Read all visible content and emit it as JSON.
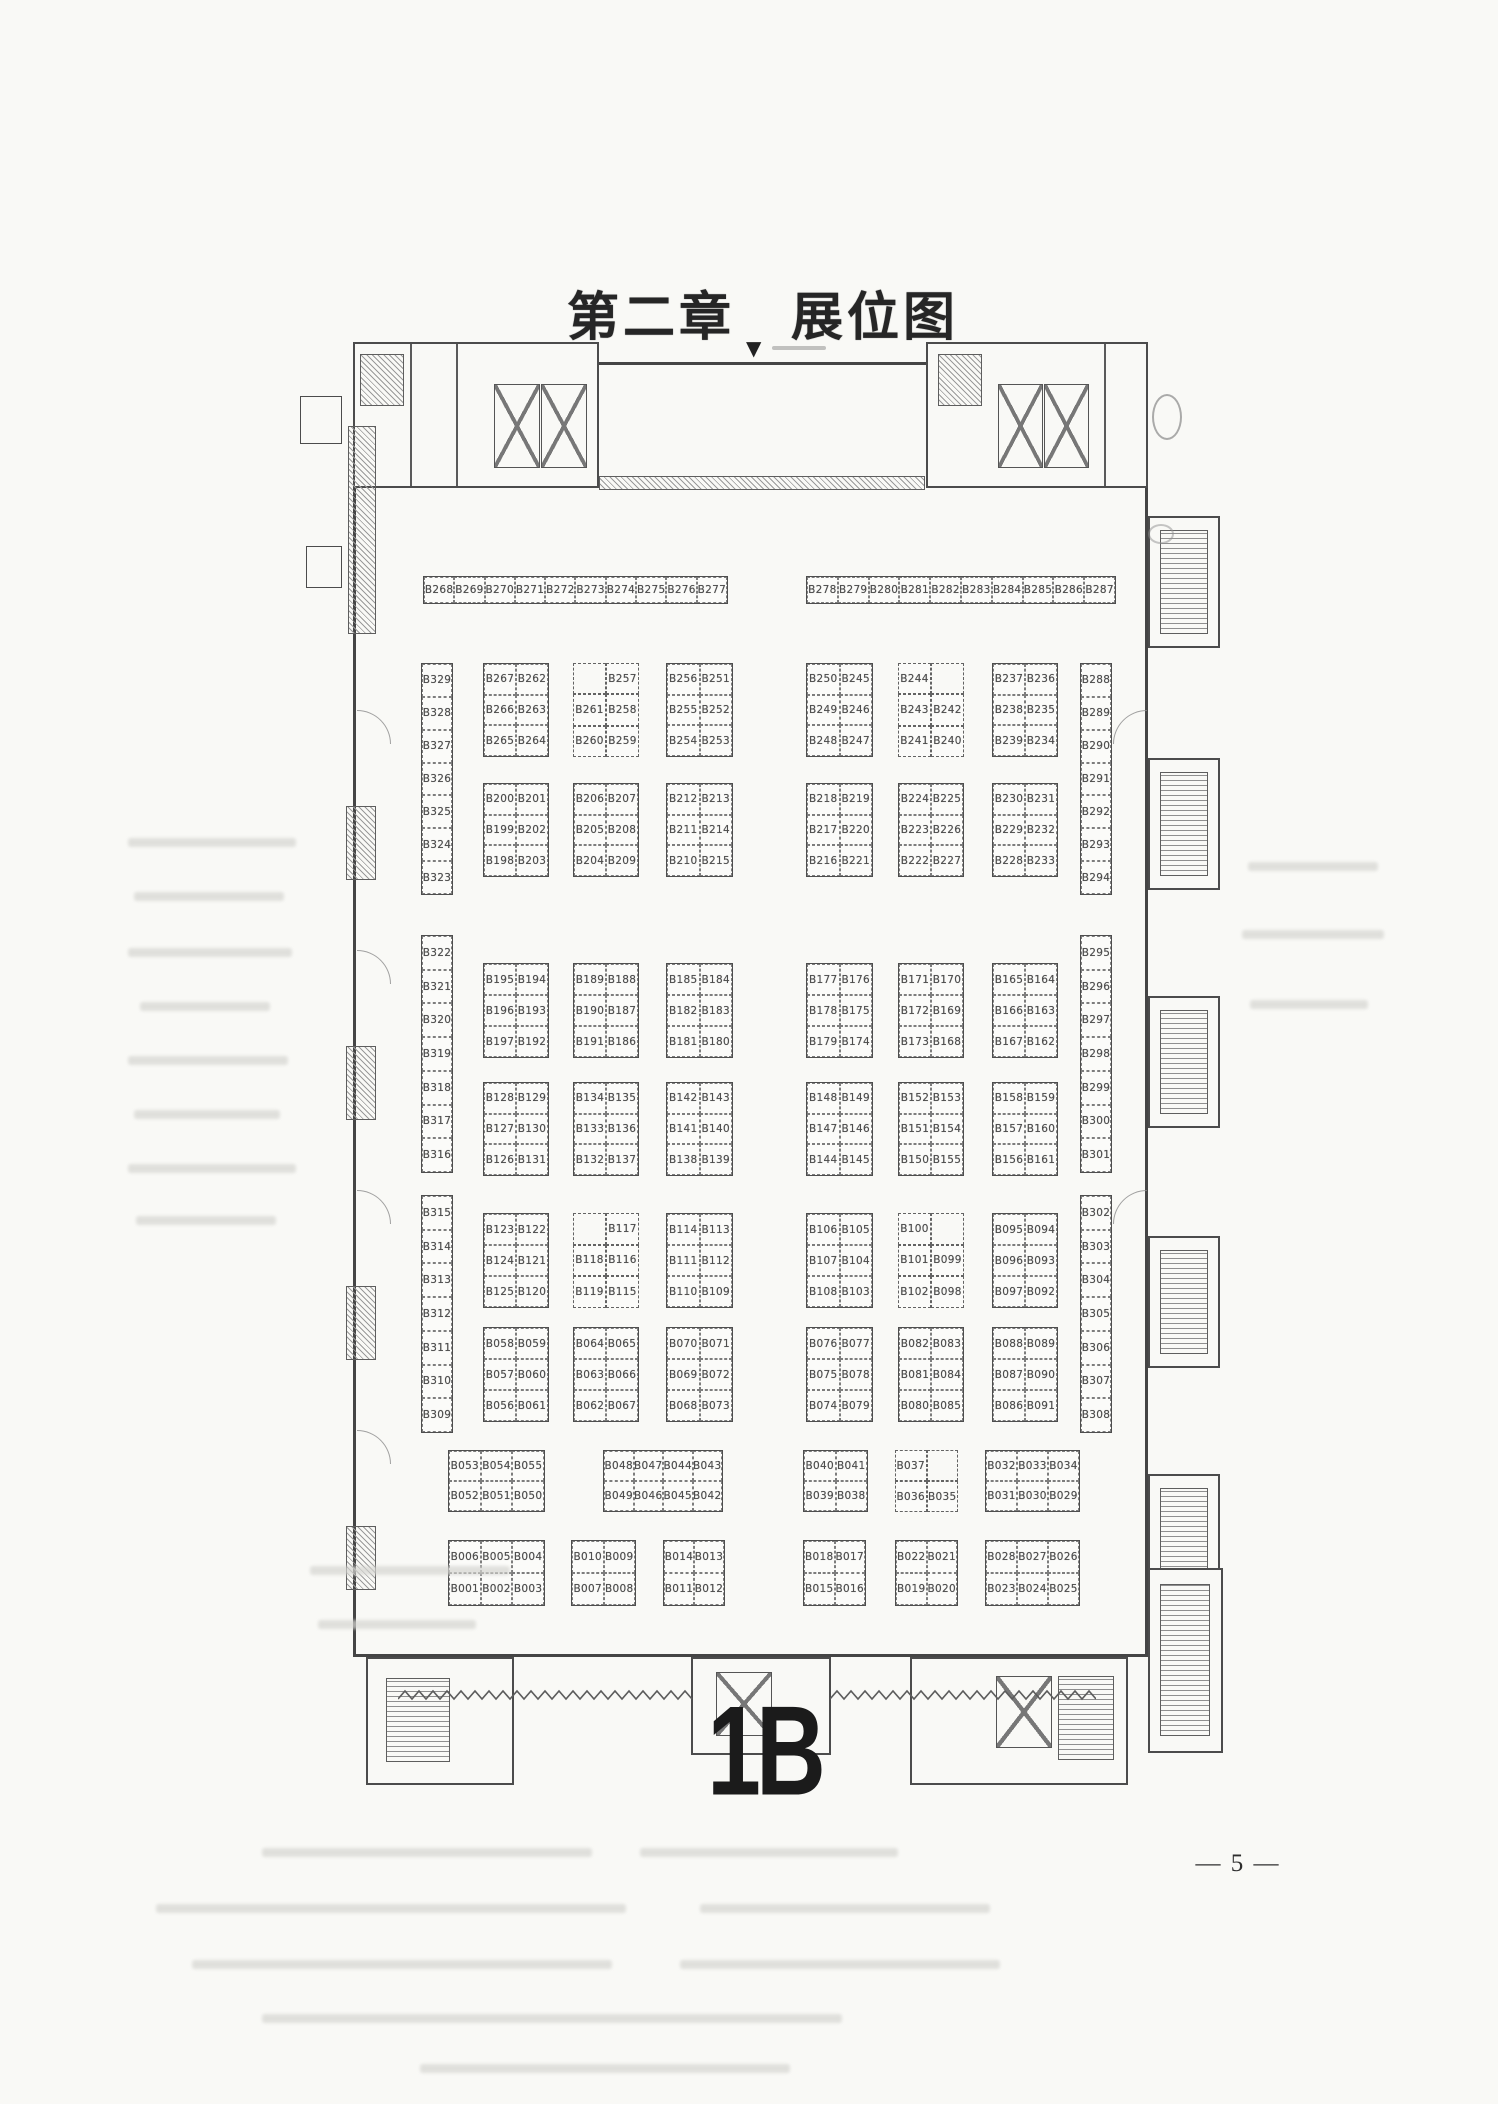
{
  "page": {
    "title": "第二章　展位图",
    "hall_label": "1B",
    "page_number": "— 5 —",
    "top_marker": "▼"
  },
  "plan": {
    "highlighted_booth": "B032",
    "highlight_color": "#d4466a",
    "groups": [
      {
        "name": "strip-left",
        "x": 125,
        "y": 238,
        "w": 305,
        "h": 28,
        "cols": 10,
        "cells": [
          "B268",
          "B269",
          "B270",
          "B271",
          "B272",
          "B273",
          "B274",
          "B275",
          "B276",
          "B277"
        ]
      },
      {
        "name": "strip-right",
        "x": 508,
        "y": 238,
        "w": 310,
        "h": 28,
        "cols": 10,
        "cells": [
          "B278",
          "B279",
          "B280",
          "B281",
          "B282",
          "B283",
          "B284",
          "B285",
          "B286",
          "B287"
        ]
      },
      {
        "name": "wall-left-a",
        "x": 123,
        "y": 325,
        "w": 32,
        "h": 232,
        "cols": 1,
        "cells": [
          "B329",
          "B328",
          "B327",
          "B326",
          "B325",
          "B324",
          "B323"
        ]
      },
      {
        "name": "wall-left-b",
        "x": 123,
        "y": 597,
        "w": 32,
        "h": 238,
        "cols": 1,
        "cells": [
          "B322",
          "B321",
          "B320",
          "B319",
          "B318",
          "B317",
          "B316"
        ]
      },
      {
        "name": "wall-left-c",
        "x": 123,
        "y": 857,
        "w": 32,
        "h": 238,
        "cols": 1,
        "cells": [
          "B315",
          "B314",
          "B313",
          "B312",
          "B311",
          "B310",
          "B309"
        ]
      },
      {
        "name": "wall-right-a",
        "x": 782,
        "y": 325,
        "w": 32,
        "h": 232,
        "cols": 1,
        "cells": [
          "B288",
          "B289",
          "B290",
          "B291",
          "B292",
          "B293",
          "B294"
        ]
      },
      {
        "name": "wall-right-b",
        "x": 782,
        "y": 597,
        "w": 32,
        "h": 238,
        "cols": 1,
        "cells": [
          "B295",
          "B296",
          "B297",
          "B298",
          "B299",
          "B300",
          "B301"
        ]
      },
      {
        "name": "wall-right-c",
        "x": 782,
        "y": 857,
        "w": 32,
        "h": 238,
        "cols": 1,
        "cells": [
          "B302",
          "B303",
          "B304",
          "B305",
          "B306",
          "B307",
          "B308"
        ]
      },
      {
        "name": "s1-l1",
        "x": 185,
        "y": 325,
        "w": 66,
        "h": 94,
        "cols": 2,
        "cells": [
          "B267",
          "B262",
          "B266",
          "B263",
          "B265",
          "B264"
        ]
      },
      {
        "name": "s1-l2",
        "x": 275,
        "y": 325,
        "w": 66,
        "h": 94,
        "cols": 2,
        "notch": true,
        "cells": [
          "",
          "B257",
          "B261",
          "B258",
          "B260",
          "B259"
        ]
      },
      {
        "name": "s1-l3",
        "x": 368,
        "y": 325,
        "w": 67,
        "h": 94,
        "cols": 2,
        "cells": [
          "B256",
          "B251",
          "B255",
          "B252",
          "B254",
          "B253"
        ]
      },
      {
        "name": "s1-r1",
        "x": 508,
        "y": 325,
        "w": 67,
        "h": 94,
        "cols": 2,
        "cells": [
          "B250",
          "B245",
          "B249",
          "B246",
          "B248",
          "B247"
        ]
      },
      {
        "name": "s1-r2",
        "x": 600,
        "y": 325,
        "w": 66,
        "h": 94,
        "cols": 2,
        "notch": true,
        "cells": [
          "B244",
          "",
          "B243",
          "B242",
          "B241",
          "B240"
        ]
      },
      {
        "name": "s1-r3",
        "x": 694,
        "y": 325,
        "w": 66,
        "h": 94,
        "cols": 2,
        "cells": [
          "B237",
          "B236",
          "B238",
          "B235",
          "B239",
          "B234"
        ]
      },
      {
        "name": "s2-l1",
        "x": 185,
        "y": 445,
        "w": 66,
        "h": 94,
        "cols": 2,
        "cells": [
          "B200",
          "B201",
          "B199",
          "B202",
          "B198",
          "B203"
        ]
      },
      {
        "name": "s2-l2",
        "x": 275,
        "y": 445,
        "w": 66,
        "h": 94,
        "cols": 2,
        "cells": [
          "B206",
          "B207",
          "B205",
          "B208",
          "B204",
          "B209"
        ]
      },
      {
        "name": "s2-l3",
        "x": 368,
        "y": 445,
        "w": 67,
        "h": 94,
        "cols": 2,
        "cells": [
          "B212",
          "B213",
          "B211",
          "B214",
          "B210",
          "B215"
        ]
      },
      {
        "name": "s2-r1",
        "x": 508,
        "y": 445,
        "w": 67,
        "h": 94,
        "cols": 2,
        "cells": [
          "B218",
          "B219",
          "B217",
          "B220",
          "B216",
          "B221"
        ]
      },
      {
        "name": "s2-r2",
        "x": 600,
        "y": 445,
        "w": 66,
        "h": 94,
        "cols": 2,
        "cells": [
          "B224",
          "B225",
          "B223",
          "B226",
          "B222",
          "B227"
        ]
      },
      {
        "name": "s2-r3",
        "x": 694,
        "y": 445,
        "w": 66,
        "h": 94,
        "cols": 2,
        "cells": [
          "B230",
          "B231",
          "B229",
          "B232",
          "B228",
          "B233"
        ]
      },
      {
        "name": "s3-l1",
        "x": 185,
        "y": 625,
        "w": 66,
        "h": 95,
        "cols": 2,
        "cells": [
          "B195",
          "B194",
          "B196",
          "B193",
          "B197",
          "B192"
        ]
      },
      {
        "name": "s3-l2",
        "x": 275,
        "y": 625,
        "w": 66,
        "h": 95,
        "cols": 2,
        "cells": [
          "B189",
          "B188",
          "B190",
          "B187",
          "B191",
          "B186"
        ]
      },
      {
        "name": "s3-l3",
        "x": 368,
        "y": 625,
        "w": 67,
        "h": 95,
        "cols": 2,
        "cells": [
          "B185",
          "B184",
          "B182",
          "B183",
          "B181",
          "B180"
        ]
      },
      {
        "name": "s3-r1",
        "x": 508,
        "y": 625,
        "w": 67,
        "h": 95,
        "cols": 2,
        "cells": [
          "B177",
          "B176",
          "B178",
          "B175",
          "B179",
          "B174"
        ]
      },
      {
        "name": "s3-r2",
        "x": 600,
        "y": 625,
        "w": 66,
        "h": 95,
        "cols": 2,
        "cells": [
          "B171",
          "B170",
          "B172",
          "B169",
          "B173",
          "B168"
        ]
      },
      {
        "name": "s3-r3",
        "x": 694,
        "y": 625,
        "w": 66,
        "h": 95,
        "cols": 2,
        "cells": [
          "B165",
          "B164",
          "B166",
          "B163",
          "B167",
          "B162"
        ]
      },
      {
        "name": "s4-l1",
        "x": 185,
        "y": 744,
        "w": 66,
        "h": 94,
        "cols": 2,
        "cells": [
          "B128",
          "B129",
          "B127",
          "B130",
          "B126",
          "B131"
        ]
      },
      {
        "name": "s4-l2",
        "x": 275,
        "y": 744,
        "w": 66,
        "h": 94,
        "cols": 2,
        "cells": [
          "B134",
          "B135",
          "B133",
          "B136",
          "B132",
          "B137"
        ]
      },
      {
        "name": "s4-l3",
        "x": 368,
        "y": 744,
        "w": 67,
        "h": 94,
        "cols": 2,
        "cells": [
          "B142",
          "B143",
          "B141",
          "B140",
          "B138",
          "B139"
        ]
      },
      {
        "name": "s4-r1",
        "x": 508,
        "y": 744,
        "w": 67,
        "h": 94,
        "cols": 2,
        "cells": [
          "B148",
          "B149",
          "B147",
          "B146",
          "B144",
          "B145"
        ]
      },
      {
        "name": "s4-r2",
        "x": 600,
        "y": 744,
        "w": 66,
        "h": 94,
        "cols": 2,
        "cells": [
          "B152",
          "B153",
          "B151",
          "B154",
          "B150",
          "B155"
        ]
      },
      {
        "name": "s4-r3",
        "x": 694,
        "y": 744,
        "w": 66,
        "h": 94,
        "cols": 2,
        "cells": [
          "B158",
          "B159",
          "B157",
          "B160",
          "B156",
          "B161"
        ]
      },
      {
        "name": "s5-l1",
        "x": 185,
        "y": 875,
        "w": 66,
        "h": 95,
        "cols": 2,
        "cells": [
          "B123",
          "B122",
          "B124",
          "B121",
          "B125",
          "B120"
        ]
      },
      {
        "name": "s5-l2",
        "x": 275,
        "y": 875,
        "w": 66,
        "h": 95,
        "cols": 2,
        "notch": true,
        "cells": [
          "",
          "B117",
          "B118",
          "B116",
          "B119",
          "B115"
        ]
      },
      {
        "name": "s5-l3",
        "x": 368,
        "y": 875,
        "w": 67,
        "h": 95,
        "cols": 2,
        "cells": [
          "B114",
          "B113",
          "B111",
          "B112",
          "B110",
          "B109"
        ]
      },
      {
        "name": "s5-r1",
        "x": 508,
        "y": 875,
        "w": 67,
        "h": 95,
        "cols": 2,
        "cells": [
          "B106",
          "B105",
          "B107",
          "B104",
          "B108",
          "B103"
        ]
      },
      {
        "name": "s5-r2",
        "x": 600,
        "y": 875,
        "w": 66,
        "h": 95,
        "cols": 2,
        "notch": true,
        "cells": [
          "B100",
          "",
          "B101",
          "B099",
          "B102",
          "B098"
        ]
      },
      {
        "name": "s5-r3",
        "x": 694,
        "y": 875,
        "w": 66,
        "h": 95,
        "cols": 2,
        "cells": [
          "B095",
          "B094",
          "B096",
          "B093",
          "B097",
          "B092"
        ]
      },
      {
        "name": "s6-l1",
        "x": 185,
        "y": 989,
        "w": 66,
        "h": 95,
        "cols": 2,
        "cells": [
          "B058",
          "B059",
          "B057",
          "B060",
          "B056",
          "B061"
        ]
      },
      {
        "name": "s6-l2",
        "x": 275,
        "y": 989,
        "w": 66,
        "h": 95,
        "cols": 2,
        "cells": [
          "B064",
          "B065",
          "B063",
          "B066",
          "B062",
          "B067"
        ]
      },
      {
        "name": "s6-l3",
        "x": 368,
        "y": 989,
        "w": 67,
        "h": 95,
        "cols": 2,
        "cells": [
          "B070",
          "B071",
          "B069",
          "B072",
          "B068",
          "B073"
        ]
      },
      {
        "name": "s6-r1",
        "x": 508,
        "y": 989,
        "w": 67,
        "h": 95,
        "cols": 2,
        "cells": [
          "B076",
          "B077",
          "B075",
          "B078",
          "B074",
          "B079"
        ]
      },
      {
        "name": "s6-r2",
        "x": 600,
        "y": 989,
        "w": 66,
        "h": 95,
        "cols": 2,
        "cells": [
          "B082",
          "B083",
          "B081",
          "B084",
          "B080",
          "B085"
        ]
      },
      {
        "name": "s6-r3",
        "x": 694,
        "y": 989,
        "w": 66,
        "h": 95,
        "cols": 2,
        "cells": [
          "B088",
          "B089",
          "B087",
          "B090",
          "B086",
          "B091"
        ]
      },
      {
        "name": "s7-g1",
        "x": 150,
        "y": 1112,
        "w": 97,
        "h": 62,
        "cols": 3,
        "cells": [
          "B053",
          "B054",
          "B055",
          "B052",
          "B051",
          "B050"
        ]
      },
      {
        "name": "s7-g2",
        "x": 305,
        "y": 1112,
        "w": 120,
        "h": 62,
        "cols": 4,
        "cells": [
          "B048",
          "B047",
          "B044",
          "B043",
          "B049",
          "B046",
          "B045",
          "B042"
        ]
      },
      {
        "name": "s7-g3",
        "x": 505,
        "y": 1112,
        "w": 65,
        "h": 62,
        "cols": 2,
        "cells": [
          "B040",
          "B041",
          "B039",
          "B038"
        ]
      },
      {
        "name": "s7-g4",
        "x": 597,
        "y": 1112,
        "w": 63,
        "h": 62,
        "cols": 2,
        "notch": true,
        "cells": [
          "B037",
          "",
          "B036",
          "B035"
        ]
      },
      {
        "name": "s7-g5",
        "x": 687,
        "y": 1112,
        "w": 95,
        "h": 62,
        "cols": 3,
        "cells": [
          "B032",
          "B033",
          "B034",
          "B031",
          "B030",
          "B029"
        ]
      },
      {
        "name": "s8-g1",
        "x": 150,
        "y": 1202,
        "w": 97,
        "h": 66,
        "cols": 3,
        "cells": [
          "B006",
          "B005",
          "B004",
          "B001",
          "B002",
          "B003"
        ]
      },
      {
        "name": "s8-g2",
        "x": 273,
        "y": 1202,
        "w": 65,
        "h": 66,
        "cols": 2,
        "cells": [
          "B010",
          "B009",
          "B007",
          "B008"
        ]
      },
      {
        "name": "s8-g3",
        "x": 365,
        "y": 1202,
        "w": 62,
        "h": 66,
        "cols": 2,
        "cells": [
          "B014",
          "B013",
          "B011",
          "B012"
        ]
      },
      {
        "name": "s8-g4",
        "x": 505,
        "y": 1202,
        "w": 63,
        "h": 66,
        "cols": 2,
        "cells": [
          "B018",
          "B017",
          "B015",
          "B016"
        ]
      },
      {
        "name": "s8-g5",
        "x": 597,
        "y": 1202,
        "w": 63,
        "h": 66,
        "cols": 2,
        "cells": [
          "B022",
          "B021",
          "B019",
          "B020"
        ]
      },
      {
        "name": "s8-g6",
        "x": 687,
        "y": 1202,
        "w": 95,
        "h": 66,
        "cols": 3,
        "cells": [
          "B028",
          "B027",
          "B026",
          "B023",
          "B024",
          "B025"
        ]
      }
    ]
  }
}
